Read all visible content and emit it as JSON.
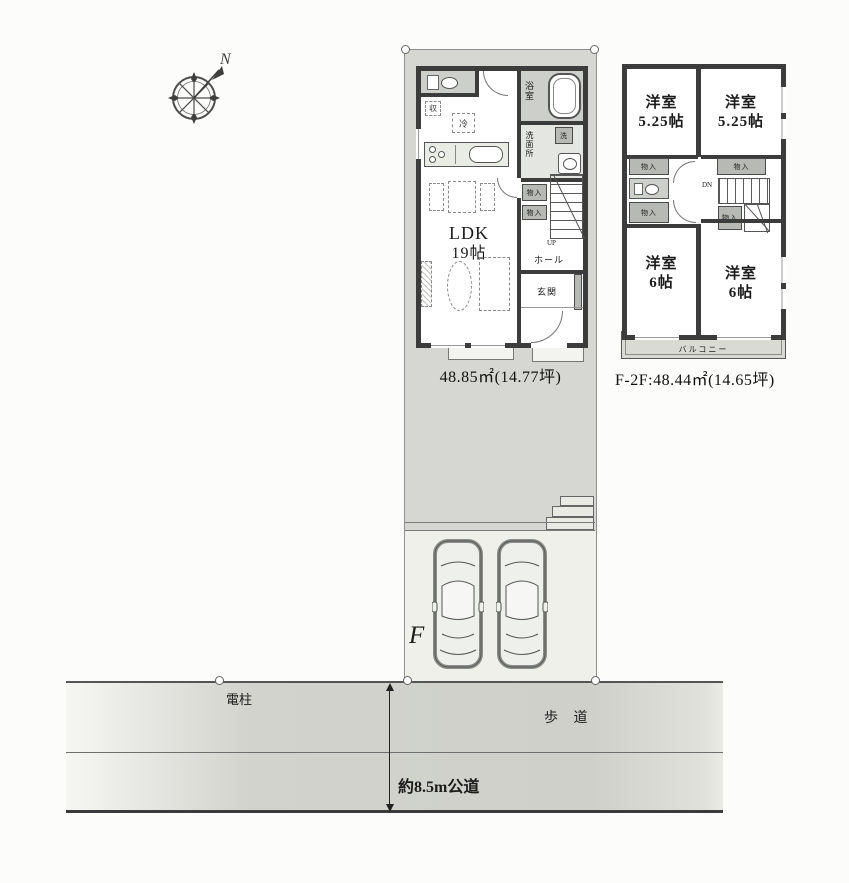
{
  "compass": {
    "north_label": "N"
  },
  "floor1": {
    "area_label": "48.85㎡(14.77坪)",
    "ldk": {
      "name": "LDK",
      "size": "19帖"
    },
    "labels": {
      "bath": "浴室",
      "washroom": "洗面所",
      "washer": "洗",
      "storage": "収",
      "fridge": "冷",
      "closet_a": "物入",
      "closet_b": "物入",
      "hall": "ホール",
      "entrance": "玄関",
      "stairs_up": "UP"
    }
  },
  "floor2": {
    "area_label": "F-2F:48.44㎡(14.65坪)",
    "rooms": {
      "nw": {
        "name": "洋室",
        "size": "5.25帖"
      },
      "ne": {
        "name": "洋室",
        "size": "5.25帖"
      },
      "sw": {
        "name": "洋室",
        "size": "6帖"
      },
      "se": {
        "name": "洋室",
        "size": "6帖"
      }
    },
    "labels": {
      "closet_nw": "物入",
      "closet_ne": "物入",
      "closet_w": "物入",
      "closet_c": "物入",
      "balcony": "バルコニー",
      "stairs_dn": "DN"
    }
  },
  "site": {
    "block_label": "F"
  },
  "road": {
    "utility_pole": "電柱",
    "sidewalk": "歩 道",
    "width_label": "約8.5m公道"
  },
  "colors": {
    "lot_fill": "#d6d7d2",
    "parking_fill": "#f0f0eb",
    "wall": "#3c3c3c",
    "closet_fill": "#b7bab4",
    "fixture_fill": "#cdd0ca",
    "road_fill": "#d2d3cd"
  }
}
